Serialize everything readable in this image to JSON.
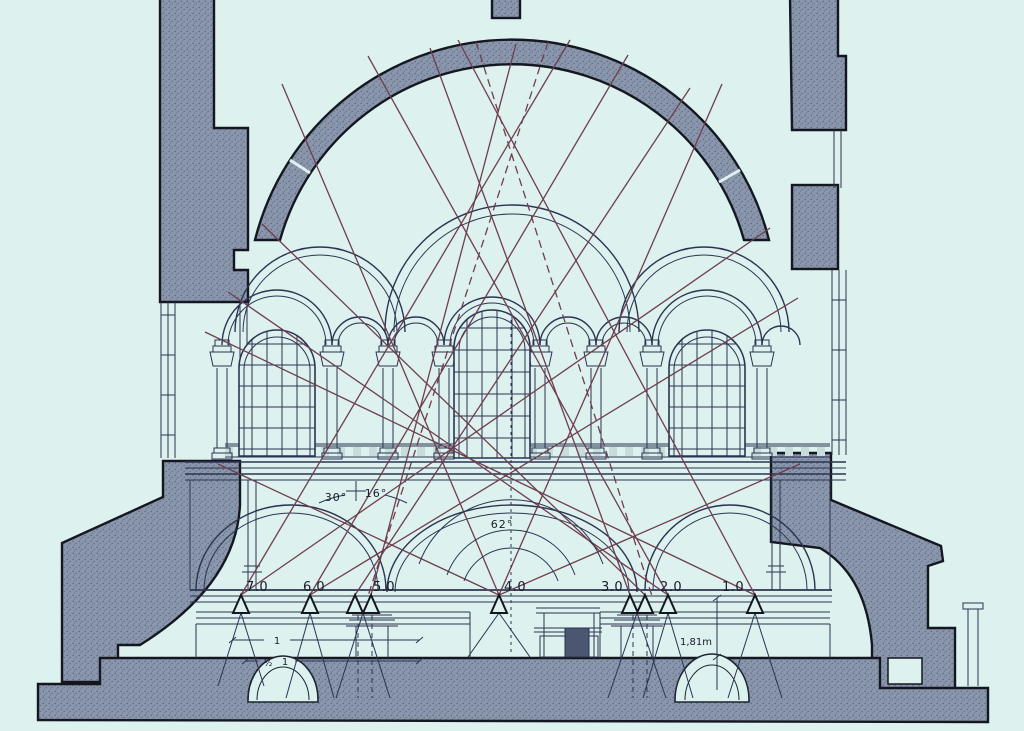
{
  "figure": {
    "type": "architectural-cross-section-with-sightline-analysis",
    "background": "#ddf1ef",
    "masonry_color": "#8a96ab",
    "outline_color": "#14171f",
    "linework_color": "#2b3450",
    "sightline_color": "#6e3e4d"
  },
  "position_labels": [
    {
      "label": "7.0"
    },
    {
      "label": "6.0"
    },
    {
      "label": "5.0"
    },
    {
      "label": "4.0"
    },
    {
      "label": "3.0"
    },
    {
      "label": "2.0"
    },
    {
      "label": "1.0"
    }
  ],
  "angle_labels": [
    {
      "label": "30°"
    },
    {
      "label": "16°"
    },
    {
      "label": "62°"
    }
  ],
  "dimension_labels": {
    "main": "1,81m",
    "crypt_upper": "1",
    "crypt_lower_frac": "½",
    "crypt_lower_num": "1"
  }
}
